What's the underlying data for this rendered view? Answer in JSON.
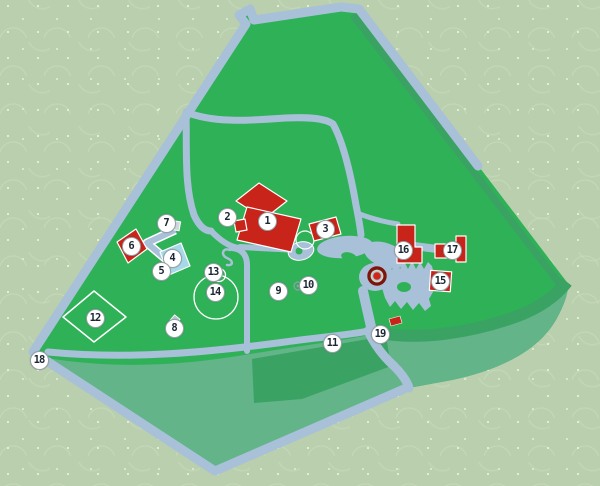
{
  "sign": {
    "kind": "park-map-sign",
    "markers": [
      {
        "label": "1",
        "x": 267,
        "y": 221
      },
      {
        "label": "2",
        "x": 227,
        "y": 217
      },
      {
        "label": "3",
        "x": 325,
        "y": 229
      },
      {
        "label": "4",
        "x": 172,
        "y": 258
      },
      {
        "label": "5",
        "x": 161,
        "y": 271
      },
      {
        "label": "6",
        "x": 131,
        "y": 246
      },
      {
        "label": "7",
        "x": 166,
        "y": 223
      },
      {
        "label": "8",
        "x": 174,
        "y": 328
      },
      {
        "label": "9",
        "x": 278,
        "y": 291
      },
      {
        "label": "10",
        "x": 308,
        "y": 285
      },
      {
        "label": "11",
        "x": 332,
        "y": 343
      },
      {
        "label": "12",
        "x": 95,
        "y": 318
      },
      {
        "label": "13",
        "x": 213,
        "y": 272
      },
      {
        "label": "14",
        "x": 215,
        "y": 292
      },
      {
        "label": "15",
        "x": 440,
        "y": 281
      },
      {
        "label": "16",
        "x": 403,
        "y": 250
      },
      {
        "label": "17",
        "x": 452,
        "y": 250
      },
      {
        "label": "18",
        "x": 39,
        "y": 360
      },
      {
        "label": "19",
        "x": 380,
        "y": 334
      }
    ]
  },
  "features": [
    "main-building-cluster",
    "pond",
    "round-lawn",
    "baseball-diamond",
    "parterre-garden",
    "fountain",
    "path-network",
    "perimeter-road"
  ],
  "colors": {
    "wallpaper": "#b9cfad",
    "lawn": "#2fb157",
    "lawn_muted": "#63b489",
    "lawn_dark": "#3aa263",
    "path": "#a8c0d8",
    "building": "#c9241a",
    "building_alt": "#a6d9e8",
    "outline": "#ffffff",
    "marker_bg": "#ffffff",
    "marker_border": "#97a0a8",
    "marker_text": "#1c2733",
    "fountain_ring": "#7e150d"
  }
}
